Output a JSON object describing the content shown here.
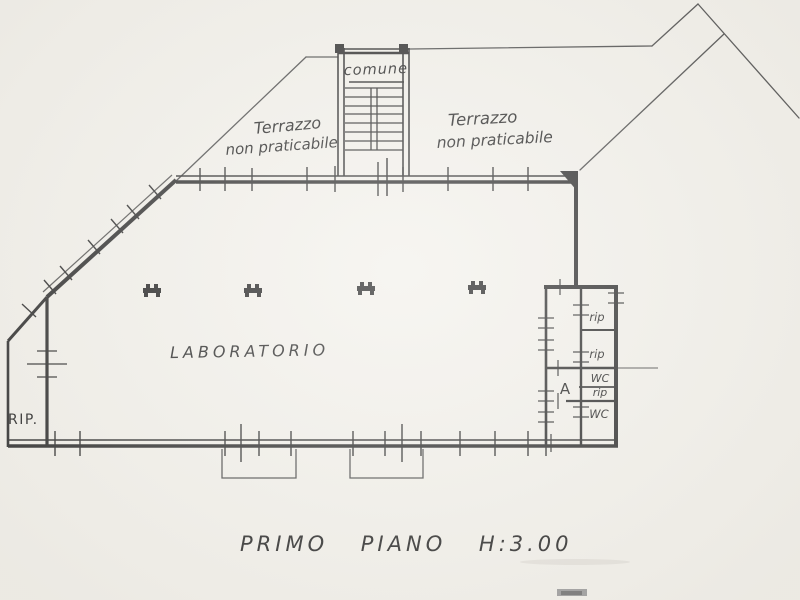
{
  "colors": {
    "paper": "#f2f0ea",
    "ink": "#2b2b2b",
    "thin_line": "#4a4a4a",
    "text_ink": "#242424"
  },
  "labels": {
    "stairwell": "comune",
    "terrace_left": {
      "line1": "Terrazzo",
      "line2": "non praticabile"
    },
    "terrace_right": {
      "line1": "Terrazzo",
      "line2": "non praticabile"
    },
    "laboratory": "LABORATORIO",
    "storage": "RIP.",
    "annex": {
      "corridor": "A",
      "rooms": [
        "rip",
        "rip",
        "WC",
        "rip",
        "WC"
      ]
    }
  },
  "caption": "PRIMO PIANO H:3.00",
  "symbols": {
    "column": "structural-column-marker",
    "window": "window-tick-marker",
    "stairs": "stair-treads"
  }
}
